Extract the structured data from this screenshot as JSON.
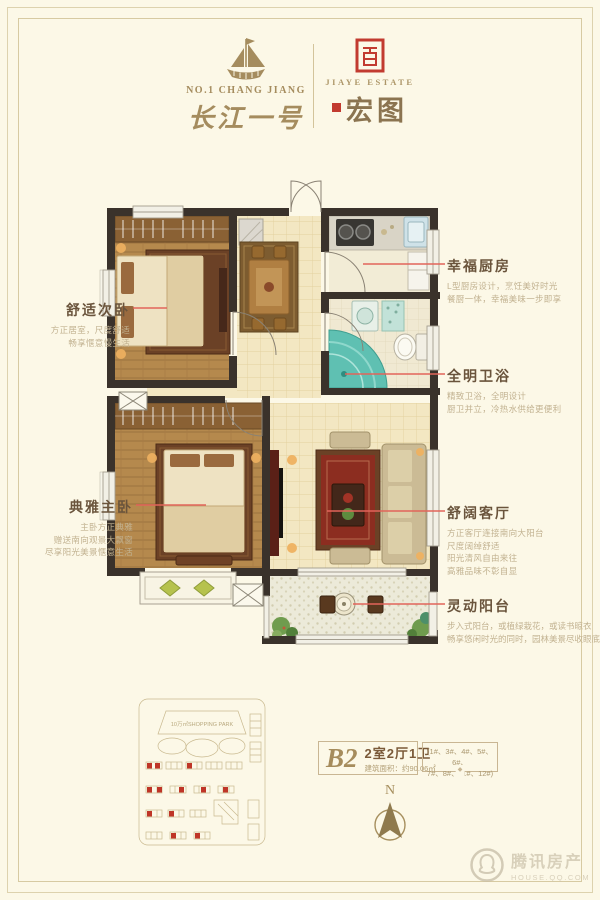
{
  "page": {
    "background": "#fcf8e7",
    "frame_color": "#ddd2ae"
  },
  "header": {
    "left_brand": {
      "latin": "NO.1 CHANG JIANG",
      "calligraphy": "长江一号"
    },
    "right_brand": {
      "latin": "JIAYE ESTATE",
      "calligraphy": "宏图"
    }
  },
  "floorplan": {
    "rooms": [
      {
        "id": "second-bedroom",
        "title": "舒适次卧",
        "desc": [
          "方正居室，尺度舒适",
          "畅享惬意慢生活"
        ]
      },
      {
        "id": "kitchen",
        "title": "幸福厨房",
        "desc": [
          "L型厨房设计，烹饪美好时光",
          "餐厨一体，幸福美味一步即享"
        ]
      },
      {
        "id": "bathroom",
        "title": "全明卫浴",
        "desc": [
          "精致卫浴，全明设计",
          "厨卫并立，冷热水供给更便利"
        ]
      },
      {
        "id": "master-bedroom",
        "title": "典雅主卧",
        "desc": [
          "主卧方正典雅",
          "赠送南向观景大飘窗",
          "尽享阳光美景惬意生活"
        ]
      },
      {
        "id": "living-room",
        "title": "舒阔客厅",
        "desc": [
          "方正客厅连接南向大阳台",
          "尺度阔绰舒适",
          "阳光清风自由来往",
          "高雅品味不彰自显"
        ]
      },
      {
        "id": "balcony",
        "title": "灵动阳台",
        "desc": [
          "步入式阳台，或植绿栽花，或读书晾衣",
          "畅享悠闲时光的同时，园林美景尽收眼底"
        ]
      }
    ]
  },
  "site_plan": {
    "park_label": "10万㎡SHOPPING PARK"
  },
  "unit_info": {
    "code": "B2",
    "layout": "2室2厅1卫",
    "area": "建筑面积：约90.06㎡",
    "buildings_line1": "(1#、3#、4#、5#、6#、",
    "buildings_line2": "7#、8#、11#、12#)"
  },
  "compass": {
    "north": "N"
  },
  "watermark": {
    "brand": "腾讯房产",
    "site": "HOUSE.QQ.COM"
  },
  "colors": {
    "accent_red": "#c23b30",
    "leader_line": "#e2645a",
    "gold": "#a58c5e",
    "wall": "#3a322b"
  }
}
